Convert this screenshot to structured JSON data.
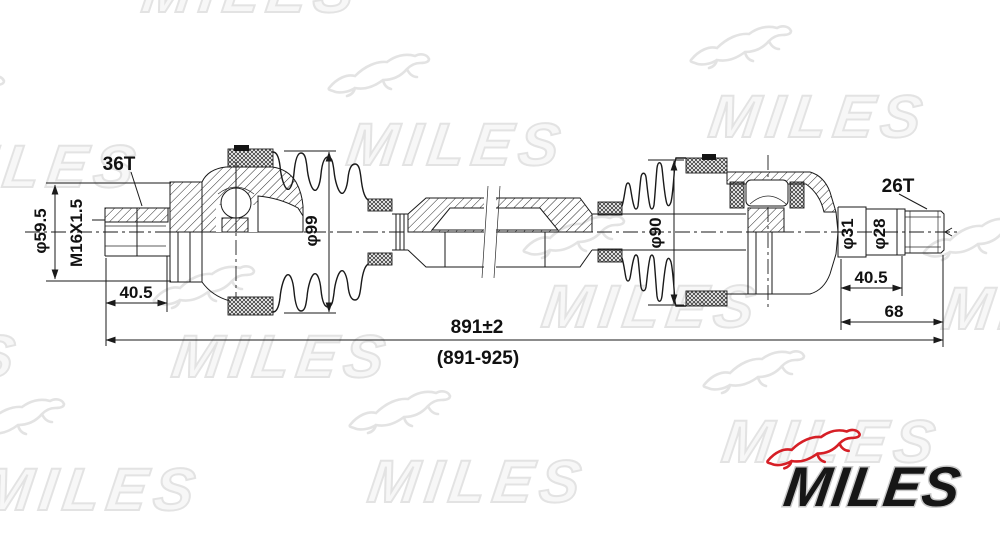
{
  "watermark": {
    "text": "MILES"
  },
  "brand_logo": {
    "text": "MILES",
    "accent_red": "#d61f26",
    "text_color": "#161616"
  },
  "drawing": {
    "title": "drive-shaft-technical-drawing",
    "dims": {
      "left_spline_teeth": "36T",
      "left_flange_diameter": "φ59.5",
      "thread_spec": "M16X1.5",
      "left_spline_length": "40.5",
      "outer_joint_diameter": "φ99",
      "inner_joint_diameter": "φ90",
      "right_spline_teeth": "26T",
      "right_step_diameter_1": "φ31",
      "right_step_diameter_2": "φ28",
      "right_step_length": "40.5",
      "right_stub_length": "68",
      "overall_length": "891±2",
      "overall_length_range": "(891-925)"
    }
  }
}
